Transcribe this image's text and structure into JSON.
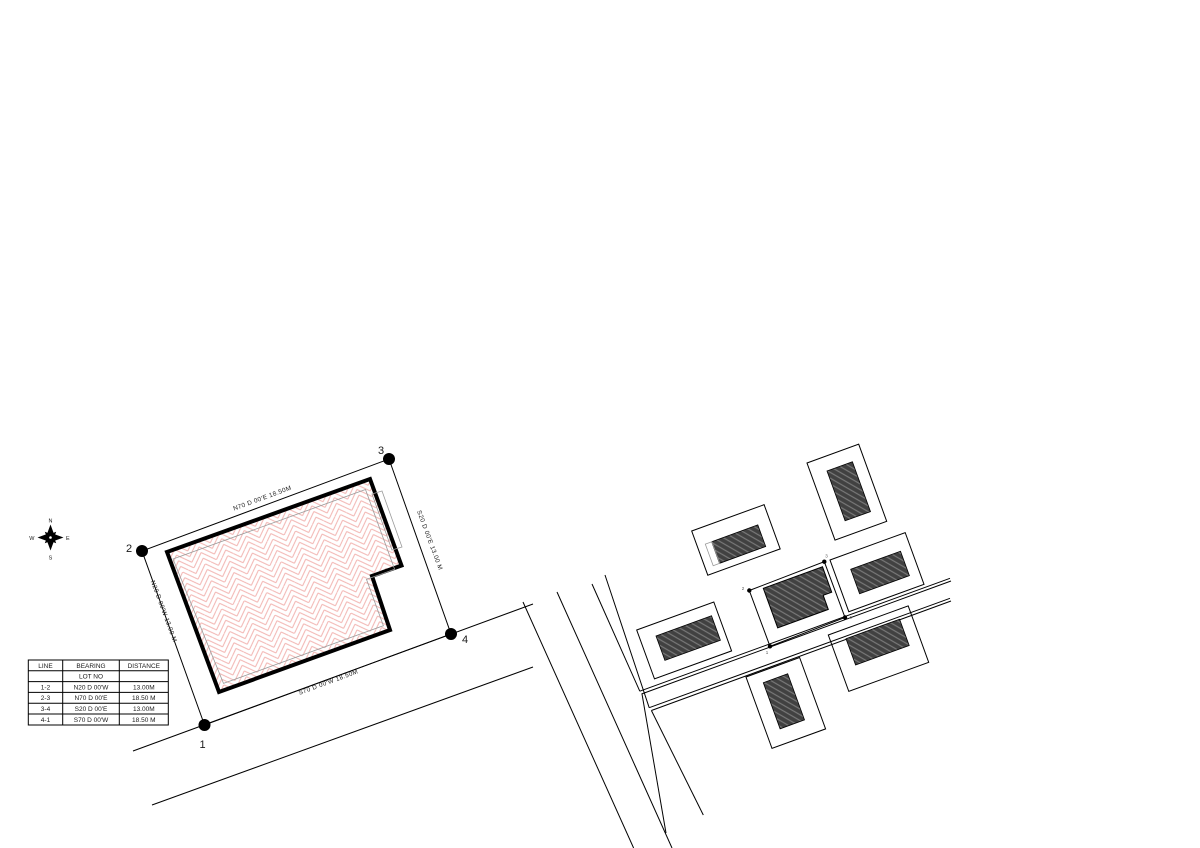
{
  "title": "Lot survey plan with vicinity map",
  "site_plan": {
    "corners": {
      "c1": "1",
      "c2": "2",
      "c3": "3",
      "c4": "4"
    },
    "bearings": {
      "top": "N70 D 00'E  18.50M",
      "right": "S20 D 00'E  13.00 M",
      "bottom": "S70 D 00'W  18.50M",
      "left": "N20 D 00'W  13.00 M"
    }
  },
  "compass": {
    "n": "N",
    "e": "E",
    "s": "S",
    "w": "W"
  },
  "lot_table": {
    "headers": {
      "line": "LINE",
      "bearing": "BEARING",
      "distance": "DISTANCE"
    },
    "subheader": "LOT NO",
    "rows": [
      {
        "line": "1-2",
        "bearing": "N20 D 00'W",
        "distance": "13.00M"
      },
      {
        "line": "2-3",
        "bearing": "N70 D 00'E",
        "distance": "18.50 M"
      },
      {
        "line": "3-4",
        "bearing": "S20 D 00'E",
        "distance": "13.00M"
      },
      {
        "line": "4-1",
        "bearing": "S70 D 00'W",
        "distance": "18.50 M"
      }
    ]
  },
  "vicinity_map": {
    "corners": {
      "c1": "1",
      "c2": "2",
      "c3": "3",
      "c4": "4"
    }
  },
  "colors": {
    "hatch_pink": "#f2b5b2",
    "building_dark": "#414141",
    "building_hatch_line": "#787878",
    "line": "#000000"
  }
}
